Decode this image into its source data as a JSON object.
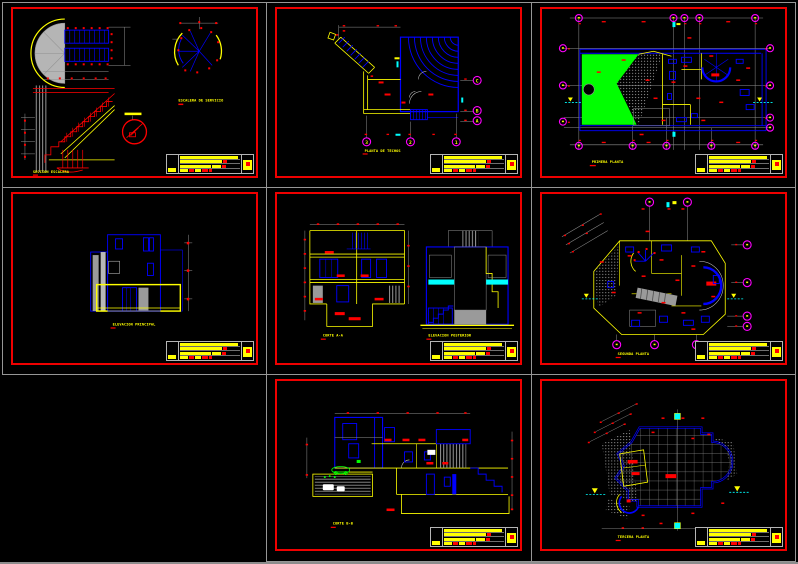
{
  "app": {
    "name": "cad-sheet-set",
    "background": "#000000"
  },
  "palette": {
    "sheet_border": "#ef0000",
    "tile_grid": "#969696",
    "red": "#ff0000",
    "yellow": "#ffff00",
    "blue": "#0000ff",
    "cyan": "#00ffff",
    "green": "#00ff00",
    "magenta": "#ff00ff",
    "gray": "#8f8f8f",
    "light_gray": "#b8b8b8",
    "white": "#ffffff"
  },
  "sheets": [
    {
      "name": "detalle-escaleras",
      "labels": [
        "ESCALERA DE SERVICIO",
        "SECCION ESCALERA"
      ]
    },
    {
      "name": "planta-de-techos",
      "labels": [
        "PLANTA DE TECHOS"
      ],
      "bubbles_right": [
        "C",
        "B",
        "A"
      ],
      "bubbles_bottom": [
        "3",
        "2",
        "1"
      ]
    },
    {
      "name": "primera-planta",
      "labels": [
        "PRIMERA PLANTA"
      ]
    },
    {
      "name": "elevacion-principal",
      "labels": [
        "ELEVACION PRINCIPAL"
      ]
    },
    {
      "name": "cortes-y-elevaciones",
      "labels": [
        "CORTE A-A",
        "ELEVACION POSTERIOR"
      ]
    },
    {
      "name": "segunda-planta",
      "labels": [
        "SEGUNDA PLANTA"
      ]
    },
    {
      "name": "corte-b-b",
      "labels": [
        "CORTE B-B"
      ]
    },
    {
      "name": "tercera-planta",
      "labels": [
        "TERCERA PLANTA"
      ]
    }
  ]
}
